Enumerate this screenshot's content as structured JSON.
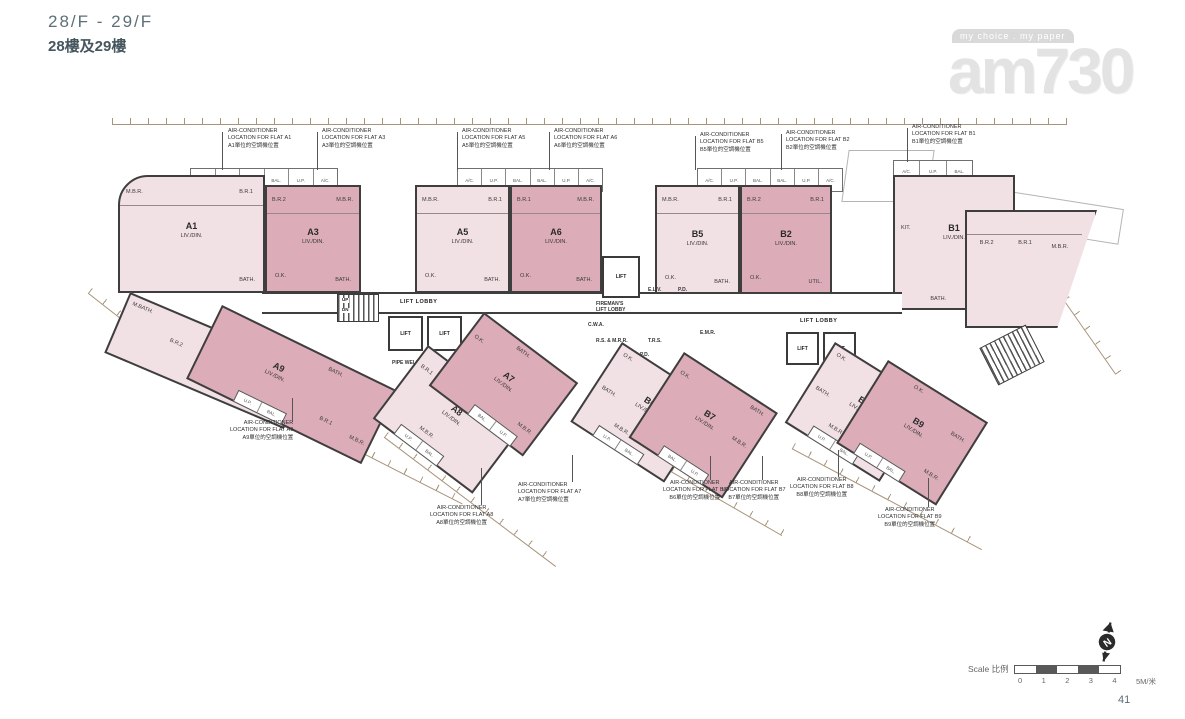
{
  "header": {
    "floor_en": "28/F - 29/F",
    "floor_zh": "28樓及29樓"
  },
  "watermark": {
    "tagline": "my choice . my paper",
    "brand": "am730"
  },
  "colors": {
    "flat_light": "#f2e1e4",
    "flat_mid": "#dcadb9",
    "wall": "#3e3e3e",
    "dimension": "#9a8164",
    "title": "#5d7078"
  },
  "balcony": {
    "s1": [
      "A/C.",
      "U.P.",
      "BAL.",
      "BAL.",
      "U.P.",
      "A/C."
    ],
    "s2": [
      "A/C.",
      "U.P.",
      "BAL.",
      "BAL.",
      "U.P.",
      "A/C."
    ],
    "s3": [
      "A/C.",
      "U.P.",
      "BAL.",
      "BAL.",
      "U.P.",
      "A/C."
    ],
    "s4": [
      "A/C.",
      "U.P.",
      "BAL."
    ]
  },
  "core": {
    "lift_lobby_left": "LIFT LOBBY",
    "lift_lobby_right": "LIFT LOBBY",
    "lift1": "LIFT",
    "lift2": "LIFT",
    "lift3": "LIFT",
    "lift4": "LIFT",
    "lift5": "LIFT",
    "fireman_l1": "FIREMAN'S",
    "fireman_l2": "LIFT LOBBY",
    "elv": "E.L.V.",
    "pd1": "P.D.",
    "pd2": "P.D.",
    "cwa": "C.W.A.",
    "rsmrr": "R.S. & M.R.R.",
    "trs": "T.R.S.",
    "emr": "E.M.R.",
    "pipe": "PIPE WELL",
    "up": "UP",
    "dn": "DN"
  },
  "flats_top": [
    {
      "name": "A1",
      "living": "LIV./DIN.",
      "r1": "M.B.R.",
      "r2": "B.R.1",
      "r3": "BATH.",
      "a1": "M.BATH.",
      "a2": "B.R.2",
      "a3": "KIT.",
      "a4": "UTIL."
    },
    {
      "name": "A3",
      "living": "LIV./DIN.",
      "r1": "B.R.2",
      "r2": "M.B.R.",
      "r3": "O.K.",
      "r4": "BATH."
    },
    {
      "name": "A5",
      "living": "LIV./DIN.",
      "r1": "M.B.R.",
      "r2": "B.R.1",
      "r3": "O.K.",
      "r4": "BATH."
    },
    {
      "name": "A6",
      "living": "LIV./DIN.",
      "r1": "B.R.1",
      "r2": "M.B.R.",
      "r3": "O.K.",
      "r4": "BATH."
    },
    {
      "name": "B5",
      "living": "LIV./DIN.",
      "r1": "M.B.R.",
      "r2": "B.R.1",
      "r3": "O.K.",
      "r4": "BATH."
    },
    {
      "name": "B2",
      "living": "LIV./DIN.",
      "r1": "B.R.2",
      "r2": "B.R.1",
      "r3": "O.K.",
      "r4": "UTIL."
    },
    {
      "name": "B1",
      "living": "LIV./DIN.",
      "r1": "KIT.",
      "r2": "B.R.2",
      "r3": "B.R.1",
      "r4": "M.B.R.",
      "r5": "BATH.",
      "r6": "M.BATH."
    }
  ],
  "flats_bottom": [
    {
      "name": "A9",
      "living": "LIV./DIN.",
      "r1": "BATH.",
      "r2": "B.R.1",
      "r3": "M.B.R.",
      "c1": "U.P.",
      "c2": "BAL."
    },
    {
      "name": "A8",
      "living": "LIV./DIN.",
      "r1": "O.K.",
      "r2": "B.R.1",
      "r3": "M.B.R.",
      "c1": "U.P.",
      "c2": "BAL."
    },
    {
      "name": "A7",
      "living": "LIV./DIN.",
      "r1": "BATH.",
      "r2": "O.K.",
      "r3": "M.B.R.",
      "c1": "BAL.",
      "c2": "U.P."
    },
    {
      "name": "B6",
      "living": "LIV./DIN.",
      "r1": "O.K.",
      "r2": "BATH.",
      "r3": "M.B.R.",
      "c1": "U.P.",
      "c2": "BAL."
    },
    {
      "name": "B7",
      "living": "LIV./DIN.",
      "r1": "O.K.",
      "r2": "BATH.",
      "r3": "M.B.R.",
      "c1": "BAL.",
      "c2": "U.P."
    },
    {
      "name": "B8",
      "living": "LIV./DIN.",
      "r1": "O.K.",
      "r2": "BATH.",
      "r3": "M.B.R.",
      "c1": "U.P.",
      "c2": "BAL."
    },
    {
      "name": "B9",
      "living": "LIV./DIN.",
      "r1": "O.K.",
      "r2": "BATH.",
      "r3": "M.B.R.",
      "c1": "U.P.",
      "c2": "BAL."
    }
  ],
  "ac_top": [
    {
      "l1": "AIR-CONDITIONER",
      "l2": "LOCATION FOR FLAT A1",
      "l3": "A1單位的空調機位置"
    },
    {
      "l1": "AIR-CONDITIONER",
      "l2": "LOCATION FOR FLAT A3",
      "l3": "A3單位的空調機位置"
    },
    {
      "l1": "AIR-CONDITIONER",
      "l2": "LOCATION FOR FLAT A5",
      "l3": "A5單位的空調機位置"
    },
    {
      "l1": "AIR-CONDITIONER",
      "l2": "LOCATION FOR FLAT A6",
      "l3": "A6單位的空調機位置"
    },
    {
      "l1": "AIR-CONDITIONER",
      "l2": "LOCATION FOR FLAT B5",
      "l3": "B5單位的空調機位置"
    },
    {
      "l1": "AIR-CONDITIONER",
      "l2": "LOCATION FOR FLAT B2",
      "l3": "B2單位的空調機位置"
    },
    {
      "l1": "AIR-CONDITIONER",
      "l2": "LOCATION FOR FLAT B1",
      "l3": "B1單位的空調機位置"
    }
  ],
  "ac_bottom": [
    {
      "l1": "AIR-CONDITIONER",
      "l2": "LOCATION FOR FLAT A9",
      "l3": "A9單位的空調機位置"
    },
    {
      "l1": "AIR-CONDITIONER",
      "l2": "LOCATION FOR FLAT A8",
      "l3": "A8單位的空調機位置"
    },
    {
      "l1": "AIR-CONDITIONER",
      "l2": "LOCATION FOR FLAT A7",
      "l3": "A7單位的空調機位置"
    },
    {
      "l1": "AIR-CONDITIONER",
      "l2": "LOCATION FOR FLAT B6",
      "l3": "B6單位的空調機位置"
    },
    {
      "l1": "AIR-CONDITIONER",
      "l2": "LOCATION FOR FLAT B7",
      "l3": "B7單位的空調機位置"
    },
    {
      "l1": "AIR-CONDITIONER",
      "l2": "LOCATION FOR FLAT B8",
      "l3": "B8單位的空調機位置"
    },
    {
      "l1": "AIR-CONDITIONER",
      "l2": "LOCATION FOR FLAT B9",
      "l3": "B9單位的空調機位置"
    }
  ],
  "scalebar": {
    "label": "Scale 比例",
    "ticks": [
      "0",
      "1",
      "2",
      "3",
      "4",
      "5M/米"
    ]
  },
  "compass": {
    "n": "N"
  },
  "footer": {
    "page": "41"
  }
}
